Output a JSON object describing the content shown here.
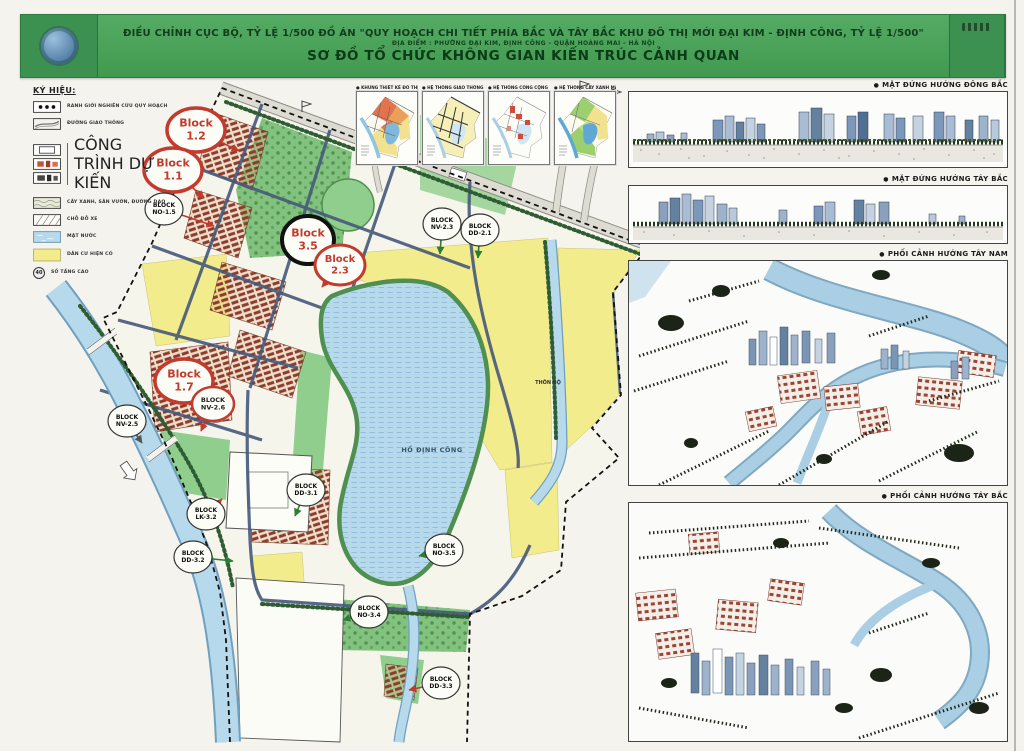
{
  "header": {
    "line1": "ĐIỀU CHỈNH CỤC BỘ, TỶ LỆ 1/500 ĐỒ ÁN \"QUY HOẠCH CHI TIẾT PHÍA BẮC VÀ TÂY BẮC KHU ĐÔ THỊ MỚI ĐẠI KIM - ĐỊNH CÔNG, TỶ LỆ 1/500\"",
    "line2": "ĐỊA ĐIỂM : PHƯỜNG ĐẠI KIM, ĐỊNH CÔNG - QUẬN HOÀNG MAI - HÀ NỘI",
    "line3": "SƠ ĐỒ TỔ CHỨC KHÔNG GIAN KIẾN TRÚC CẢNH QUAN"
  },
  "legend": {
    "title": "KÝ HIỆU:",
    "items": [
      {
        "label": "RANH GIỚI NGHIÊN CỨU QUY HOẠCH"
      },
      {
        "label": "ĐƯỜNG GIAO THÔNG"
      },
      {
        "label": "CÔNG TRÌNH DỰ KIẾN"
      },
      {
        "label": "CÂY XANH, SÂN VƯỜN, ĐƯỜNG DẠO"
      },
      {
        "label": "CHỖ ĐỖ XE"
      },
      {
        "label": "MẶT NƯỚC"
      },
      {
        "label": "DÂN CƯ HIỆN CÓ"
      },
      {
        "label": "SỐ TẦNG CAO"
      }
    ],
    "floors_badge": "40"
  },
  "insets": {
    "items": [
      {
        "label": "KHUNG THIẾT KẾ ĐÔ THỊ"
      },
      {
        "label": "HỆ THỐNG GIAO THÔNG"
      },
      {
        "label": "HỆ THỐNG CÔNG CỘNG"
      },
      {
        "label": "HỆ THỐNG CÂY XANH MẶT NƯỚC"
      }
    ],
    "bullet": "●"
  },
  "map": {
    "lake_label": "HỒ ĐỊNH CÔNG",
    "village_label": "THÔN BỘ",
    "blocks": [
      {
        "l1": "Block",
        "l2": "1.2",
        "style": "red-lg",
        "x": 196,
        "y": 130,
        "lead": {
          "x": 239,
          "y": 151,
          "c": "red"
        }
      },
      {
        "l1": "Block",
        "l2": "1.1",
        "style": "red-lg",
        "x": 173,
        "y": 170,
        "lead": {
          "x": 204,
          "y": 198,
          "c": "red"
        }
      },
      {
        "l1": "BLOCK",
        "l2": "NO-1.5",
        "style": "white",
        "x": 164,
        "y": 209,
        "lead": {
          "x": 214,
          "y": 226,
          "c": "red"
        }
      },
      {
        "l1": "Block",
        "l2": "3.5",
        "style": "black",
        "x": 308,
        "y": 240
      },
      {
        "l1": "Block",
        "l2": "2.3",
        "style": "red-md",
        "x": 340,
        "y": 265,
        "lead": {
          "x": 322,
          "y": 287,
          "c": "red"
        }
      },
      {
        "l1": "BLOCK",
        "l2": "NV-2.3",
        "style": "white",
        "x": 442,
        "y": 224,
        "lead": {
          "x": 440,
          "y": 254,
          "c": "green"
        }
      },
      {
        "l1": "BLOCK",
        "l2": "DD-2.1",
        "style": "white",
        "x": 480,
        "y": 230,
        "lead": {
          "x": 478,
          "y": 258,
          "c": "green"
        }
      },
      {
        "l1": "Block",
        "l2": "1.7",
        "style": "red-lg",
        "x": 184,
        "y": 381
      },
      {
        "l1": "BLOCK",
        "l2": "NV-2.6",
        "style": "red-sm",
        "x": 213,
        "y": 404,
        "lead": {
          "x": 201,
          "y": 431,
          "c": "red"
        }
      },
      {
        "l1": "BLOCK",
        "l2": "NV-2.5",
        "style": "white",
        "x": 127,
        "y": 421,
        "lead": {
          "x": 142,
          "y": 443,
          "c": "gray"
        }
      },
      {
        "l1": "BLOCK",
        "l2": "LK-3.2",
        "style": "white",
        "x": 206,
        "y": 514,
        "lead": {
          "x": 222,
          "y": 499,
          "c": "red"
        }
      },
      {
        "l1": "BLOCK",
        "l2": "DD-3.2",
        "style": "white",
        "x": 193,
        "y": 557,
        "lead": {
          "x": 233,
          "y": 561,
          "c": "green"
        }
      },
      {
        "l1": "BLOCK",
        "l2": "DD-3.1",
        "style": "white",
        "x": 306,
        "y": 490,
        "lead": {
          "x": 295,
          "y": 516,
          "c": "green"
        }
      },
      {
        "l1": "BLOCK",
        "l2": "NO-3.5",
        "style": "white",
        "x": 444,
        "y": 550,
        "lead": {
          "x": 419,
          "y": 556,
          "c": "green"
        }
      },
      {
        "l1": "BLOCK",
        "l2": "NO-3.4",
        "style": "white",
        "x": 369,
        "y": 612,
        "lead": {
          "x": 343,
          "y": 620,
          "c": "green"
        }
      },
      {
        "l1": "BLOCK",
        "l2": "DD-3.3",
        "style": "white",
        "x": 441,
        "y": 683,
        "lead": {
          "x": 409,
          "y": 690,
          "c": "red"
        }
      }
    ]
  },
  "panels": {
    "bullet": "●",
    "items": [
      {
        "label": "MẶT ĐỨNG HƯỚNG ĐÔNG BẮC"
      },
      {
        "label": "MẶT ĐỨNG HƯỚNG TÂY BẮC"
      },
      {
        "label": "PHỐI CẢNH HƯỚNG TÂY NAM"
      },
      {
        "label": "PHỐI CẢNH HƯỚNG TÂY BẮC"
      }
    ]
  },
  "colors": {
    "header_green": "#47a058",
    "water_blue": "#b7d9ec",
    "existing_residential_yellow": "#f3ec8d",
    "park_green": "#82c27e",
    "block_circle_red": "#c23b2e",
    "road_slate": "#46597b"
  }
}
